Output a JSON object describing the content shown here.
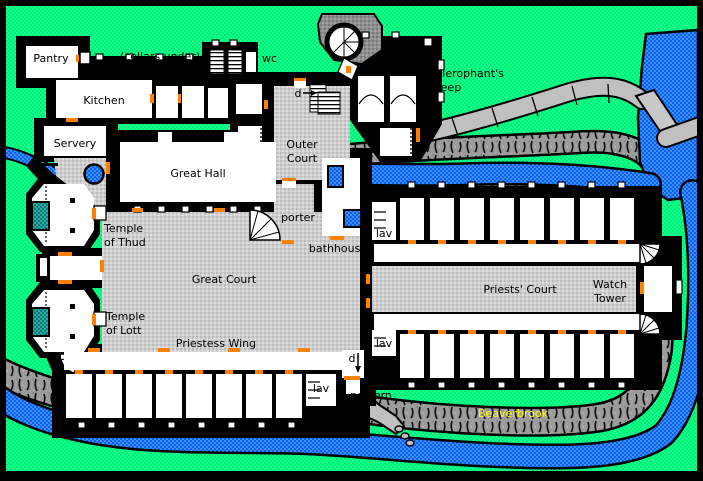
{
  "map": {
    "title": "Temple floor plan",
    "labels": {
      "pantry": "Pantry",
      "cellars_under": "(cellars under)",
      "wc": "wc",
      "hierophants_keep_line1": "Hierophant's",
      "hierophants_keep_line2": "Keep",
      "door_upper": "d",
      "kitchen": "Kitchen",
      "servery": "Servery",
      "outer_court_line1": "Outer",
      "outer_court_line2": "Court",
      "great_hall": "Great Hall",
      "porter": "porter",
      "temple_thud_line1": "Temple",
      "temple_thud_line2": "of Thud",
      "bathhouse": "bathhouse",
      "lav_north": "lav",
      "great_court": "Great Court",
      "priests_court": "Priests' Court",
      "watch_tower_line1": "Watch",
      "watch_tower_line2": "Tower",
      "temple_lott_line1": "Temple",
      "temple_lott_line2": "of Lott",
      "priestess_wing": "Priestess Wing",
      "lav_middle": "lav",
      "door_lower": "d",
      "lav_south": "lav",
      "postern": "postern",
      "river_name": "Beaverbrook"
    },
    "colors": {
      "grass_green": "#00EF76",
      "river_blue": "#1B6BF2",
      "courtyard_gray": "#CFCFCF",
      "cliff_gray": "#9C9C9C",
      "path_gray": "#C0C0C0",
      "wall_black": "#000000",
      "room_white": "#FFFFFF",
      "altar_teal": "#00807A",
      "door_orange": "#FF8000",
      "river_label_yellow": "#FFFF00",
      "text_black": "#000000"
    }
  }
}
